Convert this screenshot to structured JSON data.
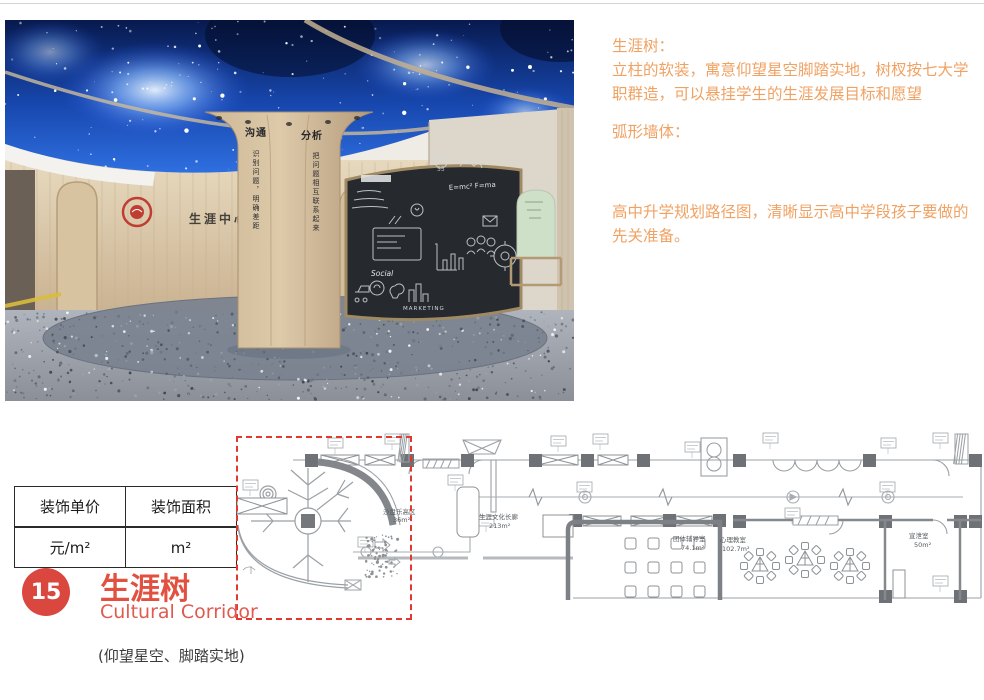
{
  "photo": {
    "column_word_left": "沟通",
    "column_word_right": "分析",
    "column_script_left": "识别问题，明确差距",
    "column_script_right": "把问题相互联系起来",
    "wall_sign": "生涯中心",
    "chalk_formula": "E=mc²  F=ma",
    "chalk_word_social": "Social",
    "chalk_word_marketing": "MARKETING"
  },
  "annotations": {
    "section1": {
      "heading": "生涯树：",
      "body": "立柱的软装，寓意仰望星空脚踏实地，树杈按七大学职群造，可以悬挂学生的生涯发展目标和愿望"
    },
    "section2": {
      "heading": "弧形墙体：",
      "body": "高中升学规划路径图，清晰显示高中学段孩子要做的先关准备。"
    }
  },
  "price_table": {
    "col1_header": "装饰单价",
    "col2_header": "装饰面积",
    "col1_value": "元/m²",
    "col2_value": "m²"
  },
  "floorplan": {
    "rooms": [
      {
        "name": "沙盘乐高区",
        "area": "36m²"
      },
      {
        "name": "生涯文化长廊",
        "area": "213m²"
      },
      {
        "name": "团体辅导室",
        "area": "74.1m²"
      },
      {
        "name": "心理教室",
        "area": "102.7m²"
      },
      {
        "name": "宣泄室",
        "area": "50m²"
      }
    ]
  },
  "footer": {
    "number": "15",
    "title": "生涯树",
    "subtitle": "Cultural Corridor",
    "tagline": "(仰望星空、脚踏实地)"
  },
  "colors": {
    "accent_orange": "#F0A263",
    "title_red": "#E2503F",
    "badge_red": "#D9473F",
    "dashed_red": "#E0392E"
  }
}
